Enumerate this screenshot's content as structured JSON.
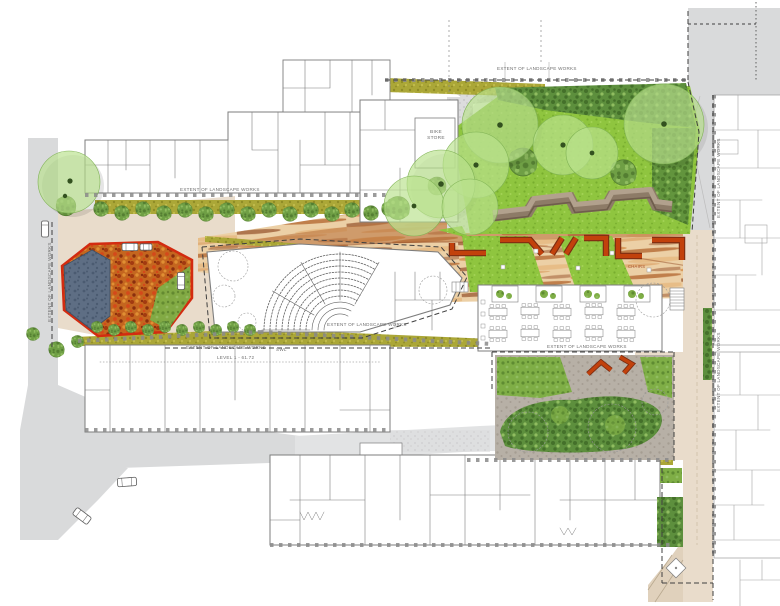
{
  "meta": {
    "type": "landscape-masterplan-site-plan",
    "canvas_width": 780,
    "canvas_height": 606
  },
  "labels": {
    "extent_of_works": "EXTENT OF LANDSCAPE WORKS",
    "bike_store": "BIKE STORE",
    "swl": "SWL",
    "level_datum": "LEVEL 1 - 61.72",
    "chairs_note": "CHAIRS"
  },
  "colors": {
    "road": "#d9dadb",
    "road_light": "#e2e3e4",
    "tan": "#e9dccb",
    "tan2": "#e0d1bc",
    "strata_base": "#ecd0a6",
    "strata1": "#d99a5c",
    "strata2": "#b9713b",
    "strata3": "#955029",
    "strata4": "#e7bd87",
    "lawn": "#8fc53f",
    "lawn_dark": "#77ad2e",
    "lawn_light": "#a4d355",
    "canopy": "#b9e18d",
    "canopy_edge": "#7fb254",
    "canopy_dot": "#33511f",
    "tree_detail": "#6f9f45",
    "tree_detail_dark": "#547e32",
    "tree_detail_light": "#90bd60",
    "shrub": "#5d8f3d",
    "shrub_dark": "#44702a",
    "planting": "#7fae46",
    "planting_dark": "#5f8c32",
    "hedge": "#aba737",
    "hedge_dark": "#8f8c26",
    "hedge_light": "#c2bd4d",
    "autumn": "#c4661f",
    "autumn1": "#a23a10",
    "autumn2": "#e08f33",
    "autumn3": "#d4491a",
    "autumn4": "#8a2f0e",
    "red_edge": "#d32b10",
    "pond": "#5e6e84",
    "pond_dark": "#4b5b71",
    "steps_top": "#b2a18d",
    "steps_mid": "#8d7b67",
    "steps_dark": "#6f5d4c",
    "bench": "#c2410c",
    "bench_dark": "#7c2d12",
    "bldg_stroke": "#7d7d7d",
    "bldg_stroke_light": "#a3a3a3",
    "boundary": "#3f3f3f",
    "tick": "#8a8a8a",
    "path_gray": "#dcdcdd",
    "path_dot": "#c6c6c8",
    "court_path": "#b7b0a6",
    "court_dot": "#a59d92",
    "car_stroke": "#5c5c5c",
    "text": "#6f6f6f",
    "text_red": "#a8502a"
  }
}
